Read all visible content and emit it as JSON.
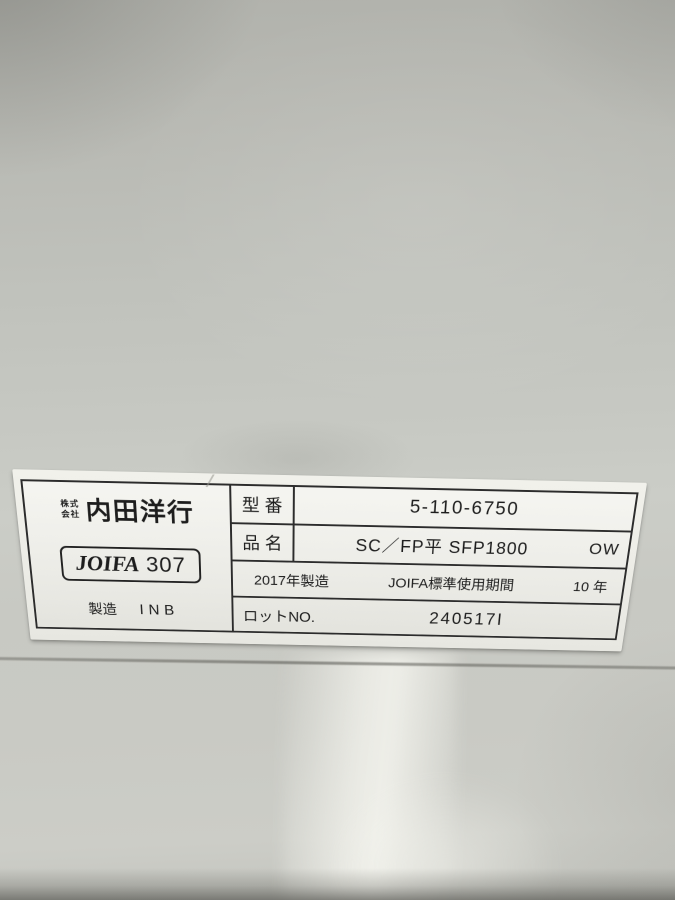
{
  "colors": {
    "ink": "#1d1d1d",
    "label_paper": "#efefe9",
    "label_border": "#2c2c2c",
    "surface_top_gray": "#b3b4ae",
    "surface_mid_gray": "#c9cbc5",
    "surface_bottom_gray": "#c4c5bf",
    "highlight_streak": "#fafaf4"
  },
  "label": {
    "maker": {
      "corp_prefix_line1": "株式",
      "corp_prefix_line2": "会社",
      "brand": "内田洋行",
      "joifa_word": "JOIFA",
      "joifa_number": "307",
      "mfg_label": "製造",
      "mfg_code": "INB"
    },
    "model_row": {
      "label": "型 番",
      "value": "5-110-6750"
    },
    "product_row": {
      "label": "品 名",
      "value": "SC／FP平 SFP1800",
      "finish_code": "OW"
    },
    "year_row": {
      "made": "2017年製造",
      "period_label": "JOIFA標準使用期間",
      "period_value": "10 年"
    },
    "lot_row": {
      "label": "ロットNO.",
      "value": "240517I"
    }
  }
}
